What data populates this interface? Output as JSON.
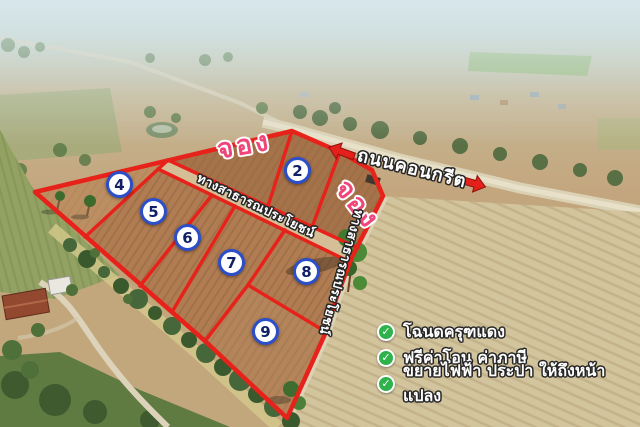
{
  "annotations": {
    "reserved_label": "จอง",
    "concrete_road_label": "ถนนคอนกรีต",
    "public_way_label": "ทางสาธารณประโยชน์"
  },
  "plots": [
    {
      "number": "2"
    },
    {
      "number": "4"
    },
    {
      "number": "5"
    },
    {
      "number": "6"
    },
    {
      "number": "7"
    },
    {
      "number": "8"
    },
    {
      "number": "9"
    }
  ],
  "features": [
    {
      "text": "โฉนดครุฑแดง"
    },
    {
      "text": "ฟรีค่าโอน ค่าภาษี"
    },
    {
      "text": "ขยายไฟฟ้า ประปา ให้ถึงหน้าแปลง"
    }
  ],
  "icons": {
    "check": "✓"
  },
  "colors": {
    "boundary_red": "#e7221a",
    "reserved_pink": "#f04578",
    "badge_ring_blue": "#2b4ec9",
    "badge_number_navy": "#101f66",
    "check_green": "#2fb24c",
    "label_white": "#ffffff"
  }
}
